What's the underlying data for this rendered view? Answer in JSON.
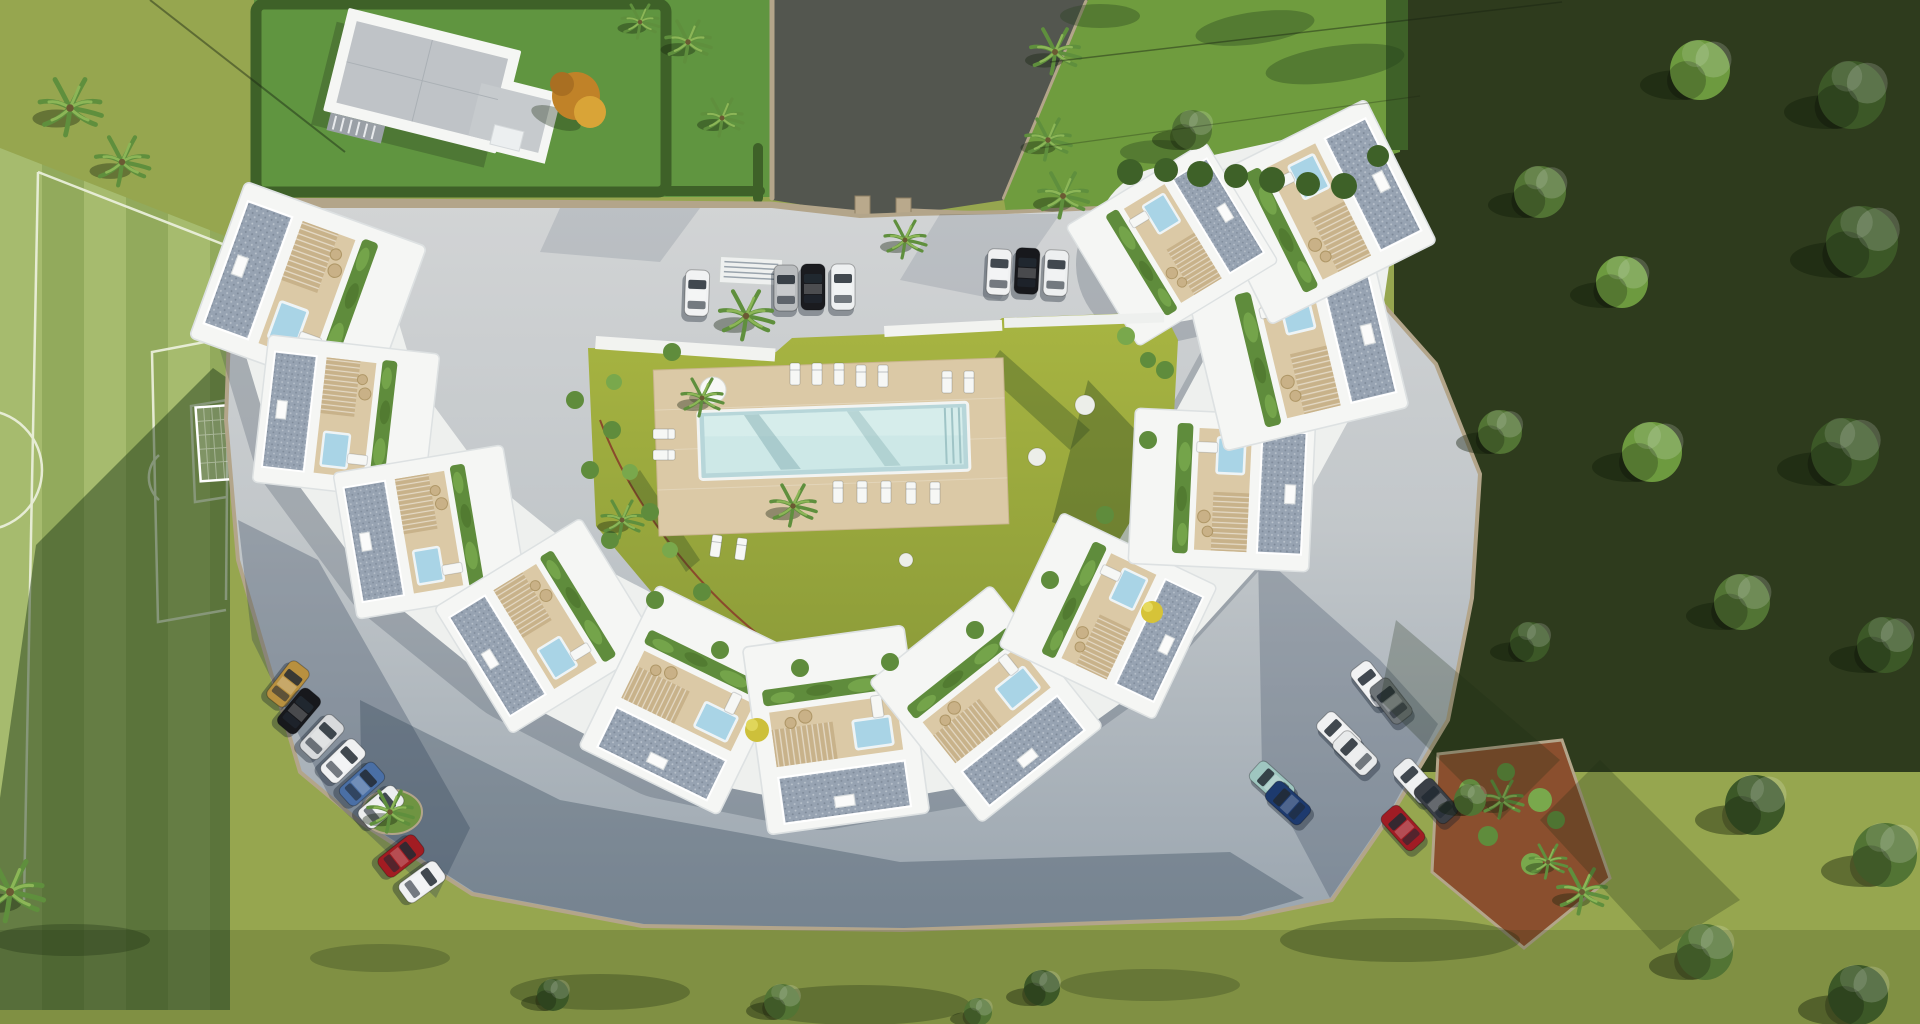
{
  "meta": {
    "title": "Aerial 3D render — crescent residential complex with central pool",
    "type": "architectural-render",
    "description": "Top-down view: white townhouses in a horseshoe around a lawn courtyard with rectangular pool and timber deck; football pitch left, detached villa top-left, entrance drive top-centre, parking arcs with cars, woodland right."
  },
  "colors": {
    "base": "#96a64f",
    "pitchA": "#a6bb6e",
    "pitchB": "#92aa5c",
    "pitchLine": "#eef2e0",
    "lawnVilla": "#609540",
    "lawnTR": "#6f9c3e",
    "hedge": "#3e6128",
    "asphalt": "#53564f",
    "wallTan": "#b3a58a",
    "paveA": "#d2d4d5",
    "paveB": "#9aa5af",
    "shadow": "#22344a",
    "courtA": "#a8b542",
    "courtB": "#8a9a38",
    "deck": "#dbc9a6",
    "pool": "#cde8e7",
    "poolDeep": "#b7d6d9",
    "gravel": "#97a3b2",
    "pergola": "#c8b28a",
    "planter": "#5f8c3c",
    "white": "#f5f6f4",
    "plunge": "#a9d4e6",
    "woodland": "#2e3b1d",
    "treeDark": "#3c5827",
    "treeMid": "#527434",
    "treeLight": "#6d9a3f",
    "palm": "#5f8f3d",
    "orange": "#c08228",
    "yellow": "#cdc03a",
    "mulch": "#8a4f2e",
    "villaRoof": "#bfc3c7",
    "furn": "#c9b187",
    "stone": "#eceee9"
  },
  "scene": {
    "courtyardCenter": {
      "x": 800,
      "y": 470
    },
    "units": [
      {
        "x": 308,
        "y": 292,
        "s": 1.12
      },
      {
        "x": 346,
        "y": 418,
        "s": 1.0
      },
      {
        "x": 430,
        "y": 532,
        "s": 1.0
      },
      {
        "x": 546,
        "y": 626,
        "s": 1.0
      },
      {
        "x": 688,
        "y": 700,
        "s": 1.05
      },
      {
        "x": 836,
        "y": 730,
        "s": 1.1
      },
      {
        "x": 986,
        "y": 704,
        "s": 1.05
      },
      {
        "x": 1108,
        "y": 616,
        "s": 1.0
      },
      {
        "x": 1222,
        "y": 490,
        "s": 1.05
      },
      {
        "x": 1298,
        "y": 350,
        "s": 1.1
      },
      {
        "x": 1318,
        "y": 212,
        "s": 1.08
      },
      {
        "x": 1172,
        "y": 244,
        "s": 0.95
      }
    ],
    "cars": [
      {
        "x": 697,
        "y": 293,
        "r": 2,
        "c": "#f1f2f3"
      },
      {
        "x": 786,
        "y": 288,
        "r": 0,
        "c": "#b9bcbe"
      },
      {
        "x": 813,
        "y": 287,
        "r": 0,
        "c": "#1a1b1f"
      },
      {
        "x": 843,
        "y": 287,
        "r": 0,
        "c": "#eef0f1"
      },
      {
        "x": 999,
        "y": 272,
        "r": 3,
        "c": "#f0f1f2"
      },
      {
        "x": 1027,
        "y": 271,
        "r": 3,
        "c": "#17181c"
      },
      {
        "x": 1056,
        "y": 273,
        "r": 3,
        "c": "#edeff0"
      },
      {
        "x": 288,
        "y": 684,
        "r": 38,
        "c": "#b8903f"
      },
      {
        "x": 299,
        "y": 711,
        "r": 40,
        "c": "#17181c"
      },
      {
        "x": 322,
        "y": 737,
        "r": 43,
        "c": "#d8dadc"
      },
      {
        "x": 343,
        "y": 761,
        "r": 46,
        "c": "#f0f1f2"
      },
      {
        "x": 362,
        "y": 784,
        "r": 48,
        "c": "#4a6fa5"
      },
      {
        "x": 381,
        "y": 807,
        "r": 50,
        "c": "#eceeef"
      },
      {
        "x": 401,
        "y": 856,
        "r": 52,
        "c": "#a21c22"
      },
      {
        "x": 422,
        "y": 882,
        "r": 54,
        "c": "#f0f1f2"
      },
      {
        "x": 1372,
        "y": 684,
        "r": -38,
        "c": "#f1f2f3"
      },
      {
        "x": 1391,
        "y": 701,
        "r": -38,
        "c": "#6e7478"
      },
      {
        "x": 1339,
        "y": 734,
        "r": -45,
        "c": "#f0f1f2"
      },
      {
        "x": 1355,
        "y": 753,
        "r": -45,
        "c": "#e8eaeb"
      },
      {
        "x": 1272,
        "y": 783,
        "r": -48,
        "c": "#9fc6c0"
      },
      {
        "x": 1288,
        "y": 803,
        "r": -48,
        "c": "#1d3a6e"
      },
      {
        "x": 1415,
        "y": 781,
        "r": -42,
        "c": "#eceeef"
      },
      {
        "x": 1436,
        "y": 801,
        "r": -42,
        "c": "#3a3f46"
      },
      {
        "x": 1403,
        "y": 828,
        "r": -42,
        "c": "#a01c24"
      }
    ],
    "palms": [
      {
        "x": 70,
        "y": 108,
        "s": 1.5
      },
      {
        "x": 122,
        "y": 162,
        "s": 1.3
      },
      {
        "x": 688,
        "y": 42,
        "s": 1.1
      },
      {
        "x": 722,
        "y": 118,
        "s": 1.0
      },
      {
        "x": 640,
        "y": 22,
        "s": 0.9
      },
      {
        "x": 1055,
        "y": 52,
        "s": 1.2
      },
      {
        "x": 1048,
        "y": 140,
        "s": 1.1
      },
      {
        "x": 1063,
        "y": 196,
        "s": 1.2
      },
      {
        "x": 746,
        "y": 316,
        "s": 1.3
      },
      {
        "x": 702,
        "y": 398,
        "s": 1.0
      },
      {
        "x": 793,
        "y": 506,
        "s": 1.1
      },
      {
        "x": 622,
        "y": 520,
        "s": 1.0
      },
      {
        "x": 905,
        "y": 240,
        "s": 1.0
      },
      {
        "x": 390,
        "y": 812,
        "s": 1.1
      },
      {
        "x": 10,
        "y": 892,
        "s": 1.6
      },
      {
        "x": 1582,
        "y": 892,
        "s": 1.2
      },
      {
        "x": 1502,
        "y": 800,
        "s": 1.0
      },
      {
        "x": 1548,
        "y": 862,
        "s": 0.9
      }
    ],
    "trees": [
      {
        "x": 1700,
        "y": 70,
        "s": 1.5,
        "tone": "treeLight"
      },
      {
        "x": 1852,
        "y": 95,
        "s": 1.7,
        "tone": "treeDark"
      },
      {
        "x": 1540,
        "y": 192,
        "s": 1.3,
        "tone": "treeMid"
      },
      {
        "x": 1622,
        "y": 282,
        "s": 1.3,
        "tone": "treeLight"
      },
      {
        "x": 1862,
        "y": 242,
        "s": 1.8,
        "tone": "treeDark"
      },
      {
        "x": 1500,
        "y": 432,
        "s": 1.1,
        "tone": "treeMid"
      },
      {
        "x": 1652,
        "y": 452,
        "s": 1.5,
        "tone": "treeLight"
      },
      {
        "x": 1845,
        "y": 452,
        "s": 1.7,
        "tone": "treeDark"
      },
      {
        "x": 1742,
        "y": 602,
        "s": 1.4,
        "tone": "treeMid"
      },
      {
        "x": 1885,
        "y": 645,
        "s": 1.4,
        "tone": "treeDark"
      },
      {
        "x": 1530,
        "y": 642,
        "s": 1.0,
        "tone": "treeDark"
      },
      {
        "x": 1755,
        "y": 805,
        "s": 1.5,
        "tone": "treeDark"
      },
      {
        "x": 1885,
        "y": 855,
        "s": 1.6,
        "tone": "treeMid"
      },
      {
        "x": 1705,
        "y": 952,
        "s": 1.4,
        "tone": "treeMid"
      },
      {
        "x": 1858,
        "y": 995,
        "s": 1.5,
        "tone": "treeDark"
      },
      {
        "x": 1470,
        "y": 800,
        "s": 0.8,
        "tone": "treeMid"
      },
      {
        "x": 553,
        "y": 995,
        "s": 0.8,
        "tone": "treeDark"
      },
      {
        "x": 782,
        "y": 1002,
        "s": 0.9,
        "tone": "treeMid"
      },
      {
        "x": 1042,
        "y": 988,
        "s": 0.9,
        "tone": "treeDark"
      },
      {
        "x": 978,
        "y": 1012,
        "s": 0.7,
        "tone": "treeMid"
      },
      {
        "x": 1192,
        "y": 130,
        "s": 1.0,
        "tone": "treeMid"
      }
    ],
    "loungers": [
      [
        795,
        374,
        0
      ],
      [
        817,
        374,
        0
      ],
      [
        839,
        374,
        0
      ],
      [
        861,
        376,
        0
      ],
      [
        883,
        376,
        0
      ],
      [
        947,
        382,
        0
      ],
      [
        969,
        382,
        0
      ],
      [
        838,
        492,
        0
      ],
      [
        862,
        492,
        0
      ],
      [
        886,
        492,
        0
      ],
      [
        911,
        493,
        0
      ],
      [
        935,
        493,
        0
      ],
      [
        664,
        434,
        90
      ],
      [
        664,
        455,
        90
      ],
      [
        716,
        546,
        8
      ],
      [
        741,
        549,
        8
      ]
    ],
    "shrubs": [
      {
        "x": 1130,
        "y": 172,
        "r": 13,
        "c": "hedge"
      },
      {
        "x": 1166,
        "y": 170,
        "r": 12,
        "c": "hedge"
      },
      {
        "x": 1200,
        "y": 174,
        "r": 13,
        "c": "hedge"
      },
      {
        "x": 1236,
        "y": 176,
        "r": 12,
        "c": "hedge"
      },
      {
        "x": 1272,
        "y": 180,
        "r": 13,
        "c": "hedge"
      },
      {
        "x": 1308,
        "y": 184,
        "r": 12,
        "c": "hedge"
      },
      {
        "x": 1344,
        "y": 186,
        "r": 13,
        "c": "hedge"
      },
      {
        "x": 1378,
        "y": 156,
        "r": 11,
        "c": "hedge"
      },
      {
        "x": 575,
        "y": 400,
        "r": 9
      },
      {
        "x": 590,
        "y": 470,
        "r": 9
      },
      {
        "x": 610,
        "y": 540,
        "r": 9
      },
      {
        "x": 655,
        "y": 600,
        "r": 9
      },
      {
        "x": 720,
        "y": 650,
        "r": 9
      },
      {
        "x": 800,
        "y": 668,
        "r": 9
      },
      {
        "x": 890,
        "y": 662,
        "r": 9
      },
      {
        "x": 975,
        "y": 630,
        "r": 9
      },
      {
        "x": 1050,
        "y": 580,
        "r": 9
      },
      {
        "x": 1105,
        "y": 515,
        "r": 9
      },
      {
        "x": 1148,
        "y": 440,
        "r": 9
      },
      {
        "x": 1165,
        "y": 370,
        "r": 9
      },
      {
        "x": 612,
        "y": 430,
        "r": 9
      },
      {
        "x": 630,
        "y": 472,
        "r": 8,
        "c": "bright"
      },
      {
        "x": 650,
        "y": 512,
        "r": 9
      },
      {
        "x": 670,
        "y": 550,
        "r": 8,
        "c": "bright"
      },
      {
        "x": 702,
        "y": 592,
        "r": 9
      },
      {
        "x": 614,
        "y": 382,
        "r": 8,
        "c": "bright"
      },
      {
        "x": 672,
        "y": 352,
        "r": 9
      },
      {
        "x": 1126,
        "y": 336,
        "r": 9,
        "c": "bright"
      },
      {
        "x": 1148,
        "y": 360,
        "r": 8
      },
      {
        "x": 1470,
        "y": 790,
        "r": 11,
        "c": "bright"
      },
      {
        "x": 1506,
        "y": 772,
        "r": 9
      },
      {
        "x": 1540,
        "y": 800,
        "r": 12,
        "c": "bright"
      },
      {
        "x": 1488,
        "y": 836,
        "r": 10
      },
      {
        "x": 1532,
        "y": 864,
        "r": 11,
        "c": "bright"
      },
      {
        "x": 1556,
        "y": 820,
        "r": 9
      }
    ],
    "stones": [
      [
        1085,
        405,
        10
      ],
      [
        1037,
        457,
        9
      ],
      [
        906,
        560,
        7
      ]
    ]
  }
}
